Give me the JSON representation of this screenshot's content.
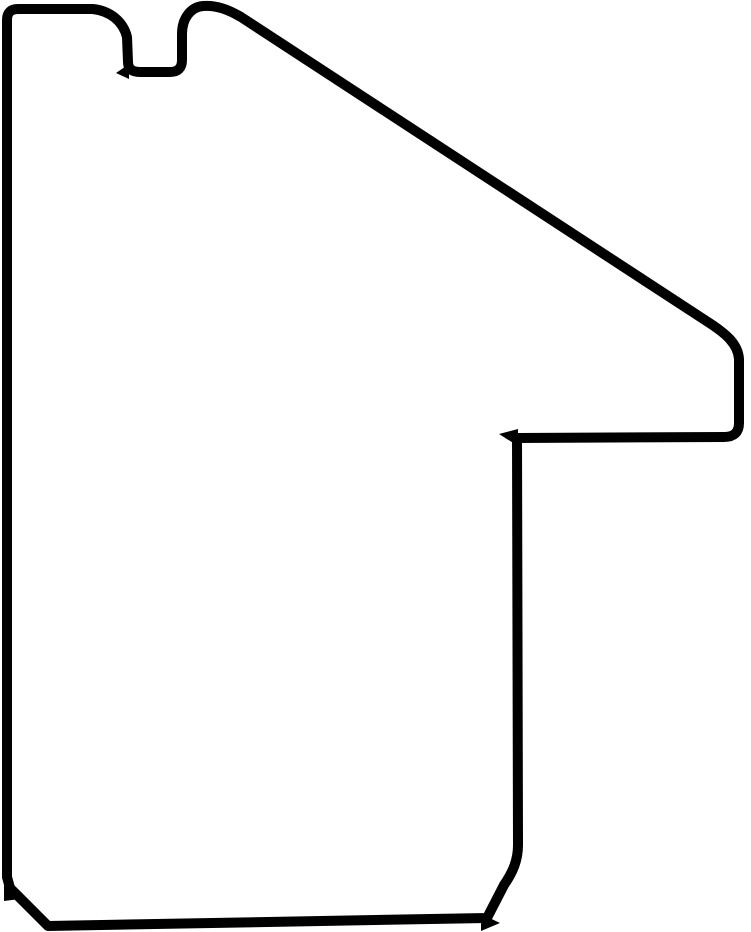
{
  "page": {
    "width_px": 751,
    "height_px": 932,
    "background_color": "#ffffff"
  },
  "figure": {
    "type": "outline-drawing",
    "description": "Thick black contour drawing on a white background: a cross-section profile of a picture-frame moulding. Flat left vertical side, short flat top with a small square groove (rabbet notch) cut into it, a rounded hump right of the notch, a long straight slope descending to the right, a short right vertical edge stepping left into a horizontal shelf, then a long vertical stem dropping to a chamfered bottom-right corner, a flat bottom edge, and a chamfered bottom-left corner.",
    "stroke_color": "#000000",
    "fill_color": "#ffffff",
    "stroke_width_px": 10,
    "outline_path": "M 7 877 L 7 20 Q 7 9 18 9 L 93 9 C 110 11 123 21 127 37 L 128 62 Q 128 72 140 72 L 170 72 Q 182 72 182 60 L 182 34 C 182 18 191 7 203 6 C 217 5 229 10 241 17 L 711 324 C 726 334 738 344 739 359 L 739 423 Q 739 437 724 437 L 517 438 L 518 845 C 518 860 513 872 504 885 L 487 918 L 48 926 L 10 888 Z",
    "spurs": [
      {
        "name": "step-corner-spur",
        "points": "518,446 499,434 518,429"
      },
      {
        "name": "bottom-chamfer-spur",
        "points": "481,914 500,923 481,931"
      },
      {
        "name": "notch-corner-spur",
        "points": "129,64 116,73 129,79"
      },
      {
        "name": "bottom-left-kink-spur",
        "points": "4,881 20,899 4,901"
      }
    ]
  }
}
